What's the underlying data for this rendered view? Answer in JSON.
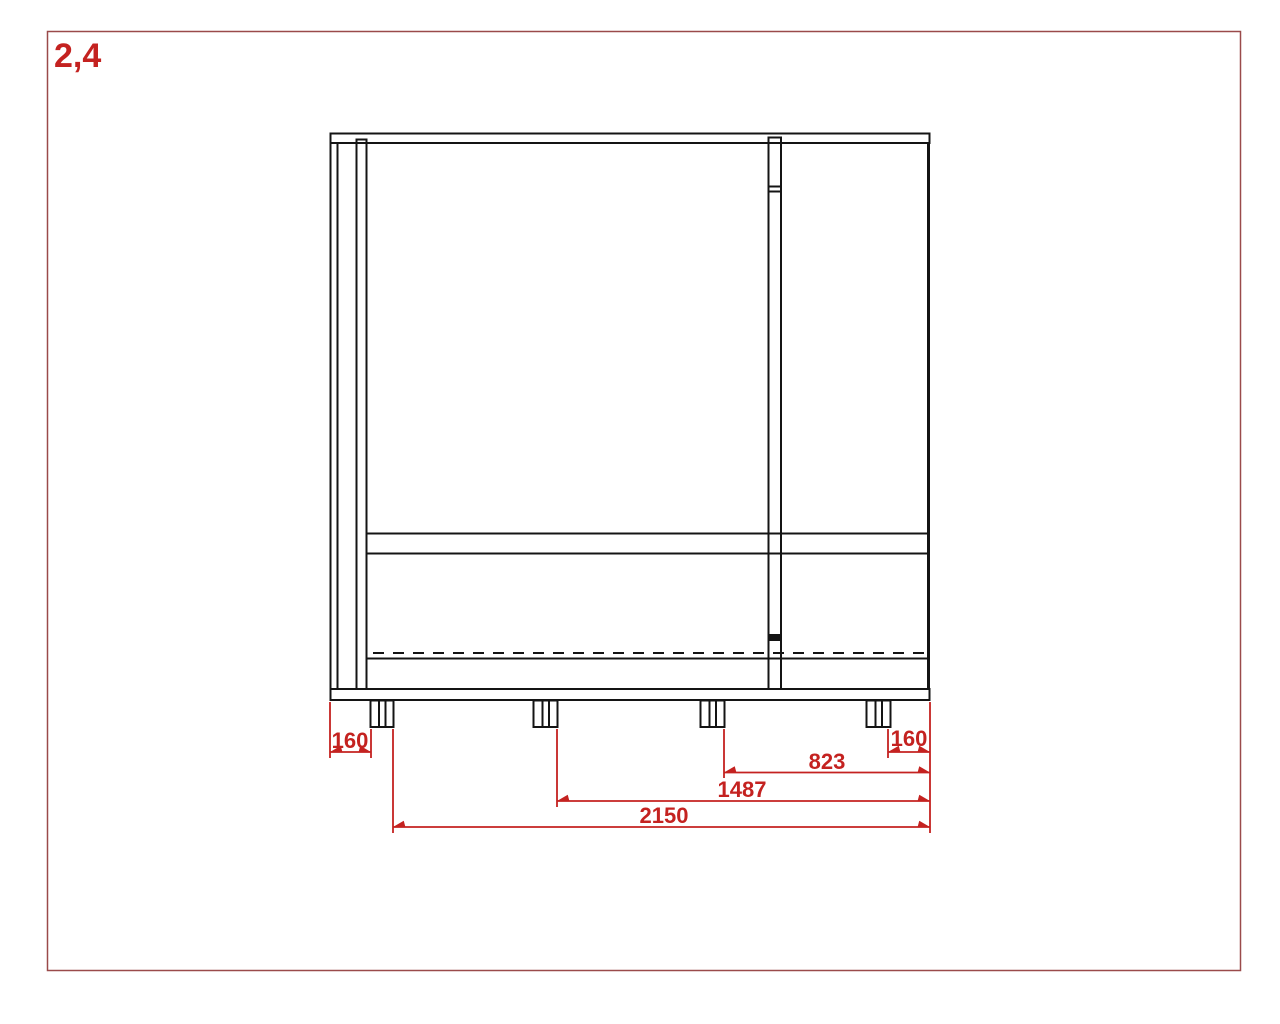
{
  "sheet": {
    "label": "2,4"
  },
  "colors": {
    "background": "#ffffff",
    "drawing": "#141414",
    "dimension": "#c42220",
    "page_border": "#9a4a4a"
  },
  "dims": {
    "left_gap": "160",
    "right_gap": "160",
    "span_823": "823",
    "span_1487": "1487",
    "overall": "2150"
  }
}
